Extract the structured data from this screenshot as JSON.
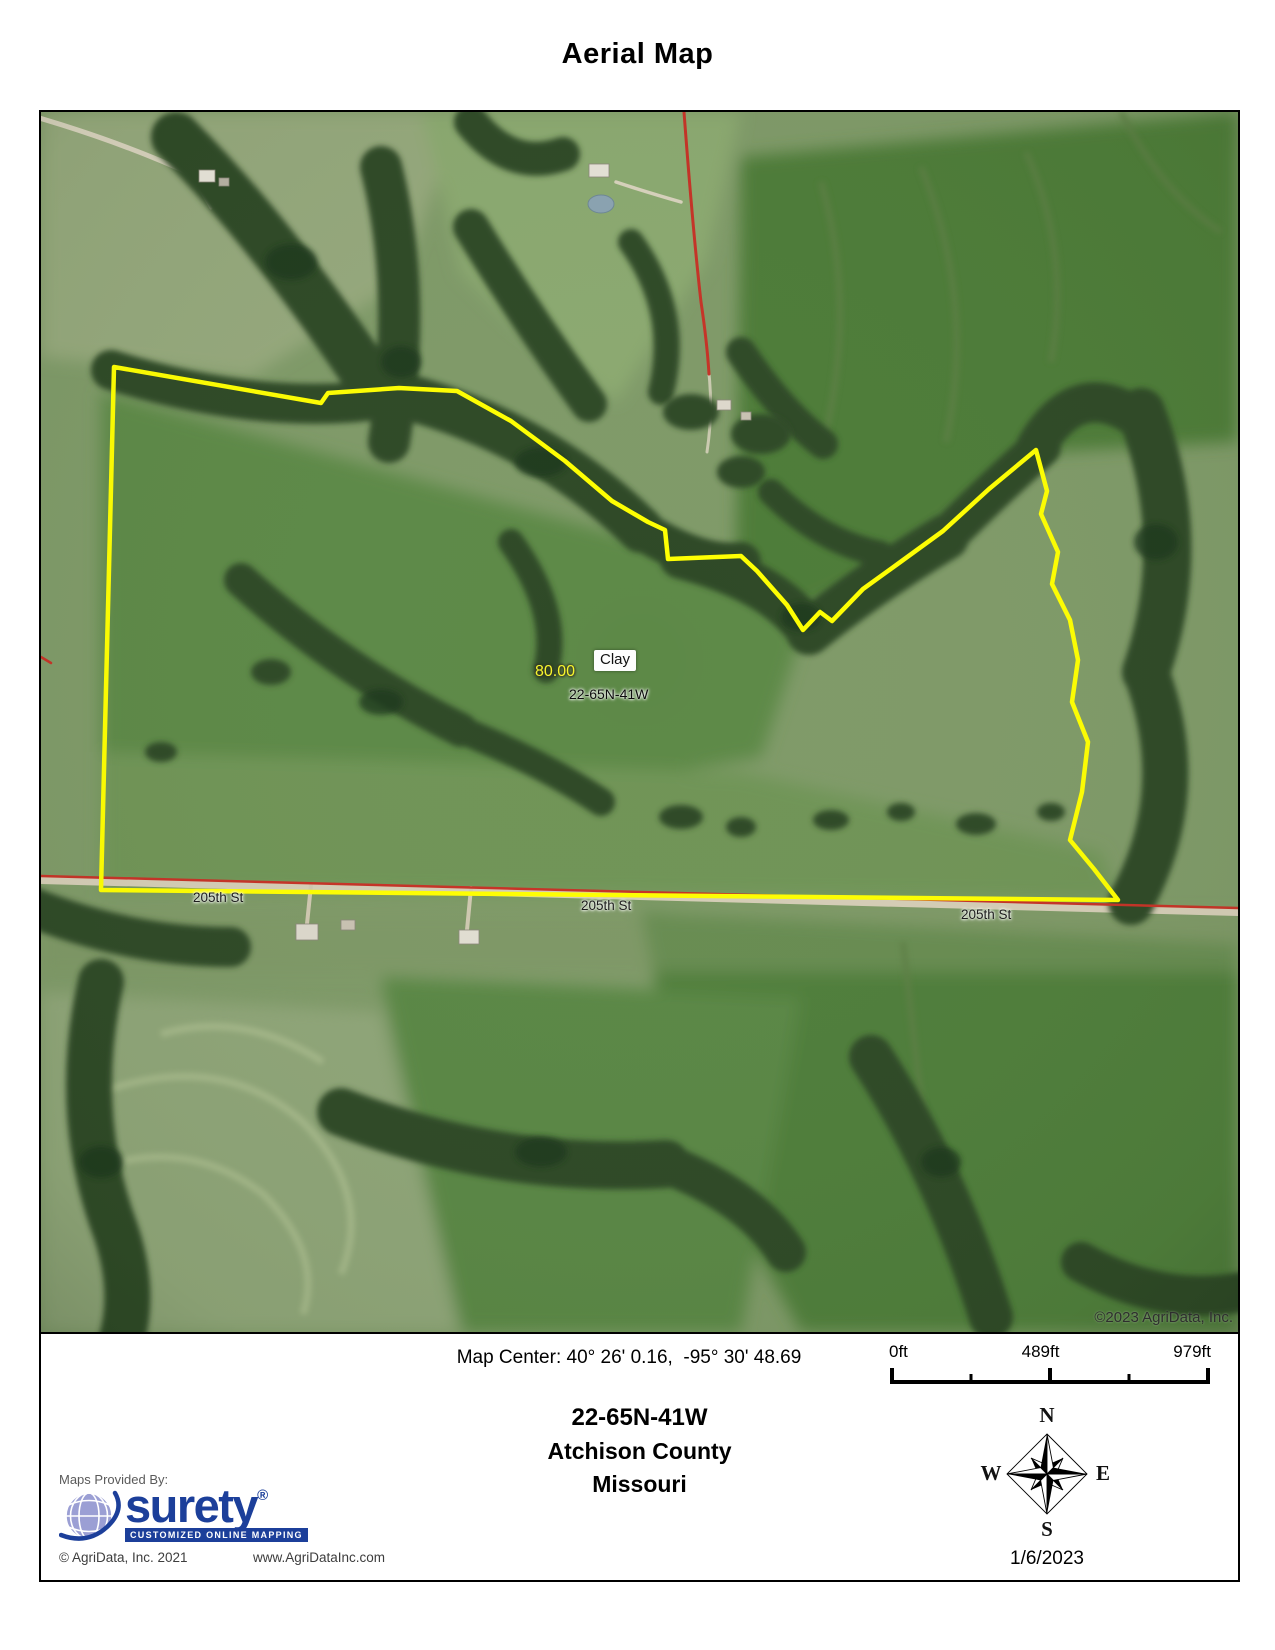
{
  "page": {
    "title": "Aerial Map"
  },
  "map": {
    "labels": {
      "acreage": "80.00",
      "soil": "Clay",
      "section": "22-65N-41W",
      "streets": [
        "205th St",
        "205th St",
        "205th St"
      ],
      "copyright": "©2023 AgriData, Inc."
    },
    "colors": {
      "parcel_boundary": "#ffff00",
      "section_line": "#c63226",
      "brand_blue": "#1c3f9a"
    }
  },
  "footer": {
    "map_center": "Map Center: 40° 26' 0.16,  -95° 30' 48.69",
    "scale": {
      "start": "0ft",
      "middle": "489ft",
      "end": "979ft"
    },
    "section": "22-65N-41W",
    "county": "Atchison County",
    "state": "Missouri",
    "provider": {
      "caption": "Maps Provided By:",
      "brand": "surety",
      "registered": "®",
      "tagline": "CUSTOMIZED ONLINE MAPPING",
      "copyright": "© AgriData, Inc. 2021",
      "website": "www.AgriDataInc.com"
    },
    "compass": {
      "n": "N",
      "s": "S",
      "e": "E",
      "w": "W"
    },
    "date": "1/6/2023"
  }
}
